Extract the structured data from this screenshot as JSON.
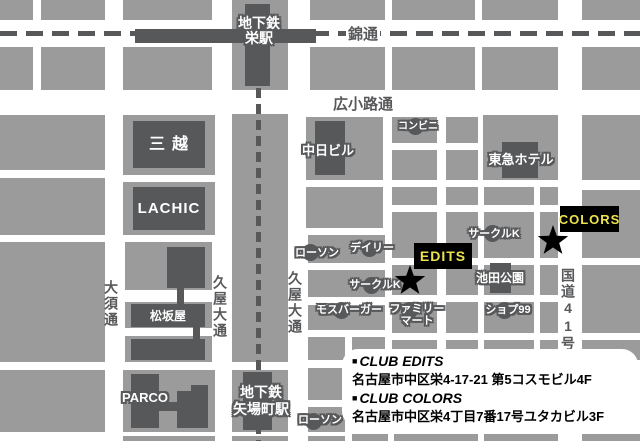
{
  "title": "CLUB EDITS / CLUB COLORS access map (Sakae, Nagoya)",
  "streets": {
    "nishiki": "錦通",
    "hirokoji": "広小路通",
    "osu": "大須通",
    "hisaya_west": "久屋大通",
    "hisaya_east": "久屋大通",
    "route41": "国道41号"
  },
  "stations": {
    "sakae": [
      "地下鉄",
      "栄駅"
    ],
    "yabacho": [
      "地下鉄",
      "矢場町駅"
    ]
  },
  "places": {
    "mitsukoshi": "三越",
    "lachic": "LACHIC",
    "chunichi_building": "中日ビル",
    "conbini": "コンビニ",
    "tokyu_hotel": "東急ホテル",
    "circle_k_north": "サークルK",
    "circle_k_south": "サークルK",
    "lawson_north": "ローソン",
    "lawson_south": "ローソン",
    "daily": "デイリー",
    "ikeda_park": "池田公園",
    "mos_burger": "モスバーガー",
    "family_mart": [
      "ファミリー",
      "マート"
    ],
    "shop99": "ショプ99",
    "matsuzakaya": "松坂屋",
    "parco": "PARCO"
  },
  "markers": {
    "edits": "EDITS",
    "colors": "COLORS"
  },
  "info_panel": {
    "items": [
      {
        "bullet": "■",
        "name": "CLUB EDITS",
        "address": "名古屋市中区栄4-17-21 第5コスモビル4F"
      },
      {
        "bullet": "■",
        "name": "CLUB COLORS",
        "address": "名古屋市中区栄4丁目7番17号ユタカビル3F"
      }
    ]
  },
  "colors": {
    "block_gray": "#9b9b9b",
    "dark_gray": "#57585a",
    "marker_bg": "#000000",
    "marker_text_yellow": "#ece24e",
    "map_bg": "#ffffff"
  }
}
